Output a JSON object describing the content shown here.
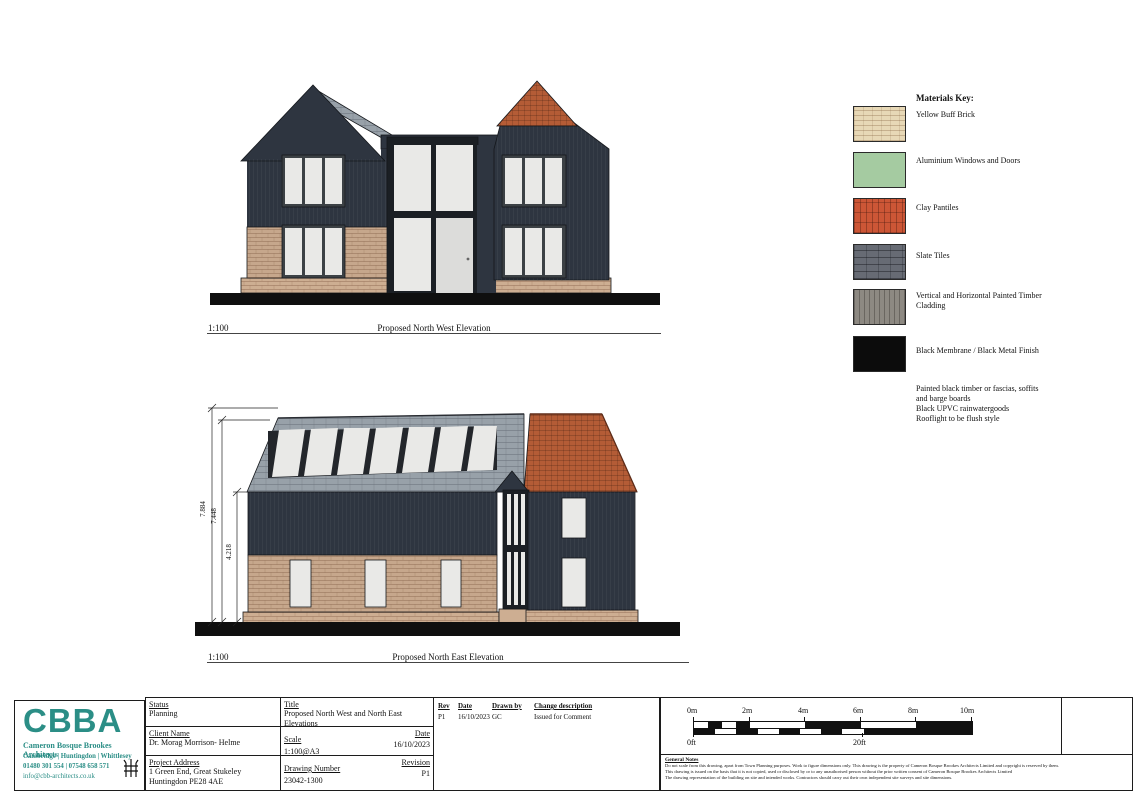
{
  "colors": {
    "dark": "#2e3540",
    "slate": "#98a1a9",
    "clay": "#b45c36",
    "brick": "#c6a78c",
    "brickl": "#cdae92",
    "pane": "#e9e9e7",
    "door": "#dcdcda",
    "ground": "#0f0f0f",
    "frame": "#3c4145",
    "teal": "#2b8e86"
  },
  "materials_key": {
    "title": "Materials Key:",
    "items": [
      {
        "name": "Yellow Buff Brick",
        "color": "#e7d8b6"
      },
      {
        "name": "Aluminium Windows and Doors",
        "color": "#a5cba1"
      },
      {
        "name": "Clay Pantiles",
        "color": "#cc5636"
      },
      {
        "name": "Slate Tiles",
        "color": "#676b74"
      },
      {
        "name": "Vertical and Horizontal Painted Timber Cladding",
        "color": "#8d8982"
      },
      {
        "name": "Black Membrane / Black Metal Finish",
        "color": "#0c0c0c"
      }
    ],
    "notes": [
      "Painted black timber or fascias, soffits",
      "and barge boards",
      "Black UPVC rainwatergoods",
      "Rooflight to be flush style"
    ]
  },
  "elevations": [
    {
      "scale": "1:100",
      "caption": "Proposed North West Elevation"
    },
    {
      "scale": "1:100",
      "caption": "Proposed North East Elevation",
      "dimensions": [
        "7.884",
        "7.448",
        "4.218"
      ]
    }
  ],
  "title_block": {
    "logo": {
      "acronym": "CBBA",
      "firm": "Cameron Bosque Brookes Architects",
      "locations": "Cambridge | Huntingdon | Whittlesey",
      "phones": "01480 301 554 | 07548 658 571",
      "email": "info@cbb-architects.co.uk"
    },
    "status_label": "Status",
    "status": "Planning",
    "client_label": "Client Name",
    "client": "Dr. Morag Morrison- Helme",
    "address_label": "Project Address",
    "address_line1": "1 Green End, Great Stukeley",
    "address_line2": "Huntingdon PE28 4AE",
    "title_label": "Title",
    "title": "Proposed North West and North East Elevations",
    "scale_label": "Scale",
    "scale": "1:100@A3",
    "date_label": "Date",
    "date": "16/10/2023",
    "drawing_number_label": "Drawing Number",
    "drawing_number": "23042-1300",
    "revision_label": "Revision",
    "revision": "P1",
    "revisions": {
      "headers": {
        "rev": "Rev",
        "date": "Date",
        "drawn_by": "Drawn by",
        "change": "Change description"
      },
      "rows": [
        {
          "rev": "P1",
          "date": "16/10/2023",
          "drawn_by": "GC",
          "change": "Issued for Comment"
        }
      ]
    },
    "scale_bar": {
      "metric": [
        "0m",
        "2m",
        "4m",
        "6m",
        "8m",
        "10m"
      ],
      "imperial": [
        "0ft",
        "20ft"
      ]
    },
    "general_notes": {
      "heading": "General Notes",
      "lines": [
        "Do not scale from this drawing, apart from Town Planning purposes. Work to figure dimensions only. This drawing is the property of Cameron Bosque Brookes Architects Limited and copyright is reserved by them.",
        "This drawing is issued on the basis that it is not copied, used or disclosed by or to any unauthorised person without the prior written consent of Cameron Bosque Brookes Architects Limited",
        "The drawing representation of the building on site and intended works. Contractors should carry out their own independent site surveys and site dimensions."
      ]
    }
  }
}
